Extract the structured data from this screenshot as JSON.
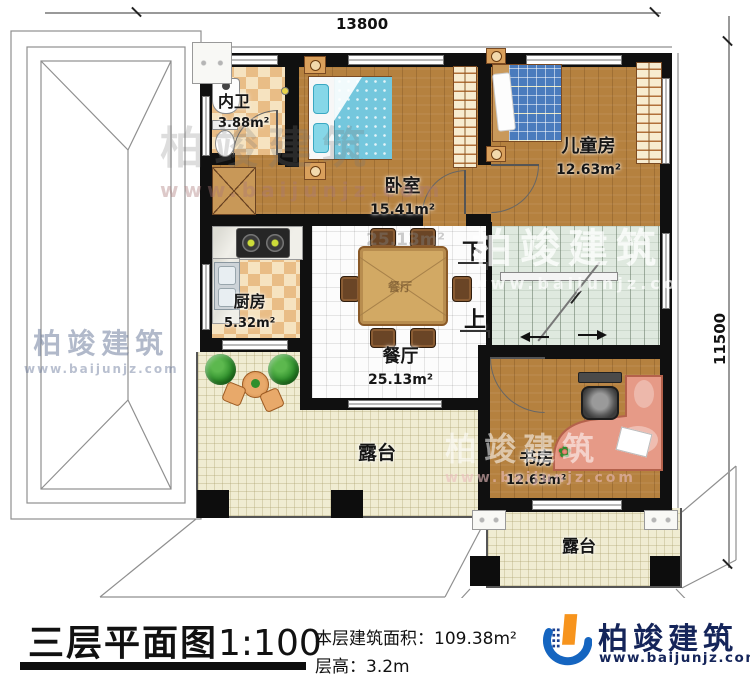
{
  "dimensions": {
    "top": "13800",
    "right": "11500"
  },
  "rooms": {
    "bathroom": {
      "name": "内卫",
      "area": "3.88m²"
    },
    "bedroom": {
      "name": "卧室",
      "area": "15.41m²"
    },
    "kids": {
      "name": "儿童房",
      "area": "12.63m²"
    },
    "kitchen": {
      "name": "厨房",
      "area": "5.32m²"
    },
    "dining": {
      "name": "餐厅",
      "area": "25.13m²",
      "ghost": "25.13m²",
      "table": "餐厅"
    },
    "study": {
      "name": "书房",
      "area": "12.63m²"
    },
    "terrace_main": {
      "name": "露台"
    },
    "terrace_small": {
      "name": "露台"
    }
  },
  "stairs": {
    "down": "下",
    "up": "上"
  },
  "title_block": {
    "title": "三层平面图",
    "scale": "1:100",
    "area_label": "本层建筑面积：",
    "area_value": "109.38m²",
    "height_label": "层高：",
    "height_value": "3.2m"
  },
  "brand": {
    "name": "柏竣建筑",
    "url": "www.baijunjz.com"
  },
  "watermark": {
    "name": "柏竣建筑",
    "url": "www.baijunjz.com"
  },
  "colors": {
    "wall": "#101010",
    "logo_blue": "#1565c0",
    "logo_orange": "#f7941d",
    "logo_navy": "#15255a"
  }
}
